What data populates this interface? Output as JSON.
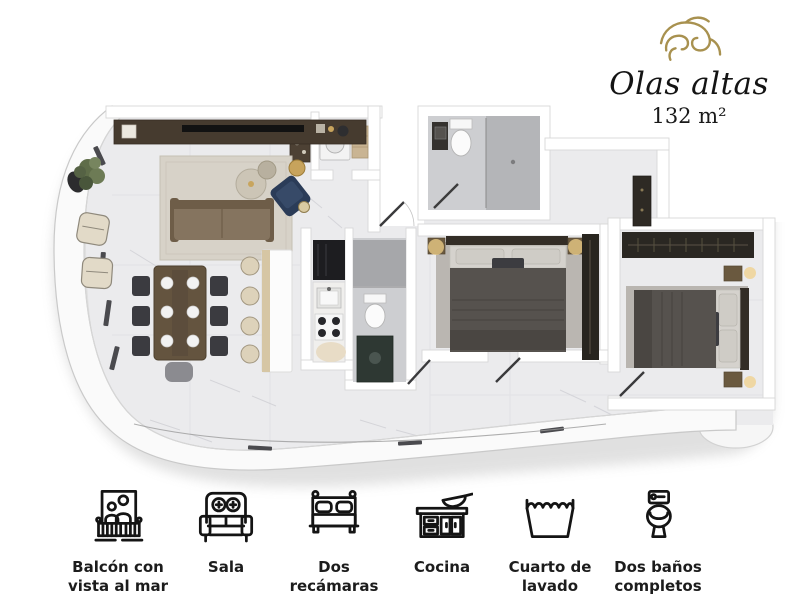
{
  "brand": {
    "name": "Olas altas",
    "area": "132 m²",
    "accent_color": "#a8914f",
    "text_color": "#141414"
  },
  "floor_plan": {
    "type": "apartment-floor-plan",
    "rooms": [
      "balcon",
      "sala",
      "comedor",
      "cocina",
      "cuarto-de-lavado",
      "bano-1",
      "bano-2",
      "recamara-1",
      "recamara-2",
      "vestibulo"
    ],
    "colors": {
      "floor": "#ebebed",
      "walls": "#ffffff",
      "wood": "#64543f",
      "navy": "#2b3c58",
      "dark_gray": "#56524e",
      "beige": "#ddd2ba",
      "gold": "#f0d08a"
    }
  },
  "features": [
    {
      "icon": "balcony-icon",
      "label": "Balcón con\nvista al mar"
    },
    {
      "icon": "sofa-icon",
      "label": "Sala"
    },
    {
      "icon": "bed-icon",
      "label": "Dos\nrecámaras"
    },
    {
      "icon": "kitchen-icon",
      "label": "Cocina"
    },
    {
      "icon": "laundry-icon",
      "label": "Cuarto de\nlavado"
    },
    {
      "icon": "toilet-icon",
      "label": "Dos baños\ncompletos"
    }
  ]
}
